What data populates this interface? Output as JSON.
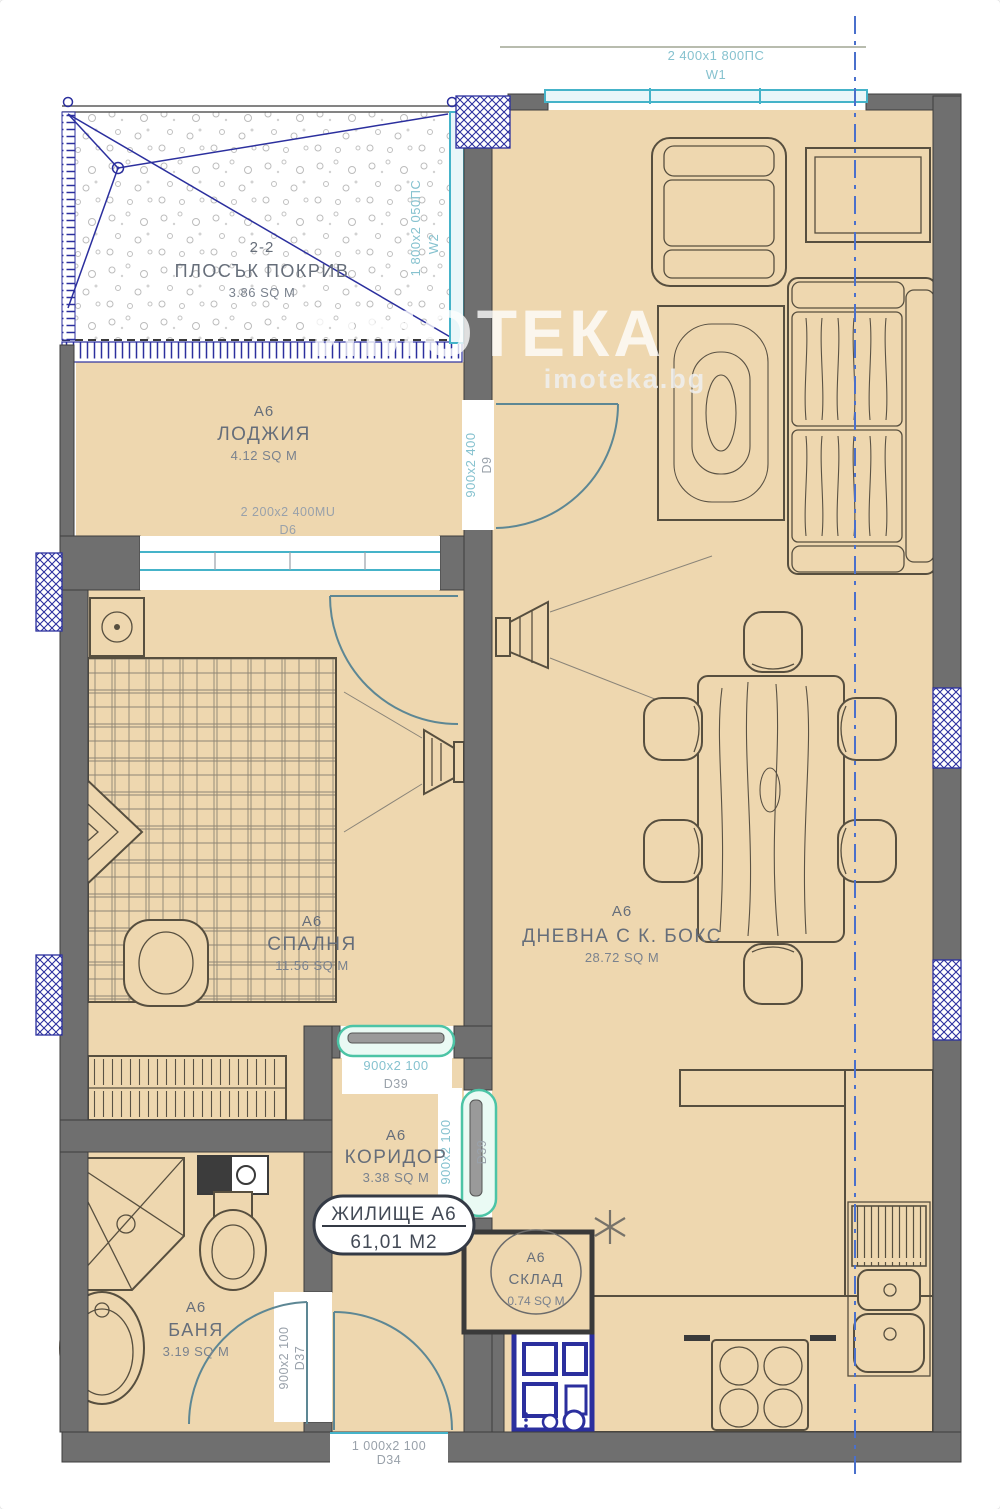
{
  "watermark": {
    "title": "ИМОТЕКА",
    "site": "imoteka.bg"
  },
  "rooms": {
    "roof": {
      "code": "2-2",
      "name": "ПЛОСЪК ПОКРИВ",
      "area": "3.86 SQ M"
    },
    "loggia": {
      "code": "A6",
      "name": "ЛОДЖИЯ",
      "area": "4.12 SQ M"
    },
    "bedroom": {
      "code": "A6",
      "name": "СПАЛНЯ",
      "area": "11.56 SQ M"
    },
    "living": {
      "code": "A6",
      "name": "ДНЕВНА С К. БОКС",
      "area": "28.72 SQ M"
    },
    "corridor": {
      "code": "A6",
      "name": "КОРИДОР",
      "area": "3.38 SQ M"
    },
    "storage": {
      "code": "A6",
      "name": "СКЛАД",
      "area": "0.74 SQ M"
    },
    "bathroom": {
      "code": "A6",
      "name": "БАНЯ",
      "area": "3.19 SQ M"
    }
  },
  "unit_badge": {
    "title": "ЖИЛИЩЕ A6",
    "area": "61,01 М2"
  },
  "openings": {
    "w1": {
      "size": "2 400x1 800ПС",
      "id": "W1"
    },
    "w2": {
      "size": "1 800x2 050ПС",
      "id": "W2"
    },
    "d6": {
      "size": "2 200x2 400MU",
      "id": "D6"
    },
    "d9": {
      "size": "900x2 400",
      "id": "D9"
    },
    "d39_top": {
      "size": "900x2 100",
      "id": "D39"
    },
    "d39_side": {
      "size": "900x2 100",
      "id": "D39"
    },
    "d37": {
      "size": "900x2 100",
      "id": "D37"
    },
    "d34": {
      "size": "1 000x2 100",
      "id": "D34"
    }
  },
  "colors": {
    "floor": "#eed7af",
    "wall": "#6f6f6f",
    "window_teal": "#45b3c9",
    "hatch_navy": "#2b2f9e",
    "sliding_door_green": "#4cc4a6",
    "section_line_blue": "#4a70cc",
    "room_label": "#666e7a",
    "dim_label": "#99a1aa",
    "window_label": "#86c2cf"
  }
}
